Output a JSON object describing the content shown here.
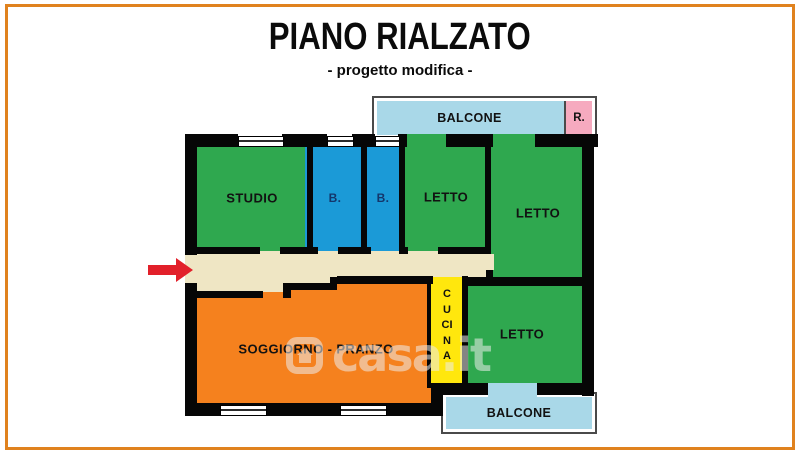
{
  "title": "PIANO RIALZATO",
  "subtitle": "- progetto modifica -",
  "frame_color": "#E0821E",
  "watermark": {
    "text": "casa.it",
    "logo": "casa-it-house-logo"
  },
  "floorplan": {
    "wall_color": "#060606",
    "entrance_arrow_color": "#E2202A",
    "corridor_color": "#EFE6C4",
    "rooms": {
      "studio": {
        "label": "STUDIO",
        "color": "#2FA84F"
      },
      "bath1": {
        "label": "B.",
        "color": "#1B9AD7"
      },
      "bath2": {
        "label": "B.",
        "color": "#1B9AD7"
      },
      "letto1": {
        "label": "LETTO",
        "color": "#2FA84F"
      },
      "letto2": {
        "label": "LETTO",
        "color": "#2FA84F"
      },
      "letto3": {
        "label": "LETTO",
        "color": "#2FA84F"
      },
      "soggiorno": {
        "label": "SOGGIORNO - PRANZO",
        "color": "#F5811E"
      },
      "cucina": {
        "label": "CUCINA",
        "color": "#FFE70D"
      },
      "balcone_top": {
        "label": "BALCONE",
        "color": "#A9D8E8"
      },
      "ripostiglio": {
        "label": "R.",
        "color": "#F6AABF"
      },
      "balcone_bottom": {
        "label": "BALCONE",
        "color": "#A9D8E8"
      }
    }
  }
}
